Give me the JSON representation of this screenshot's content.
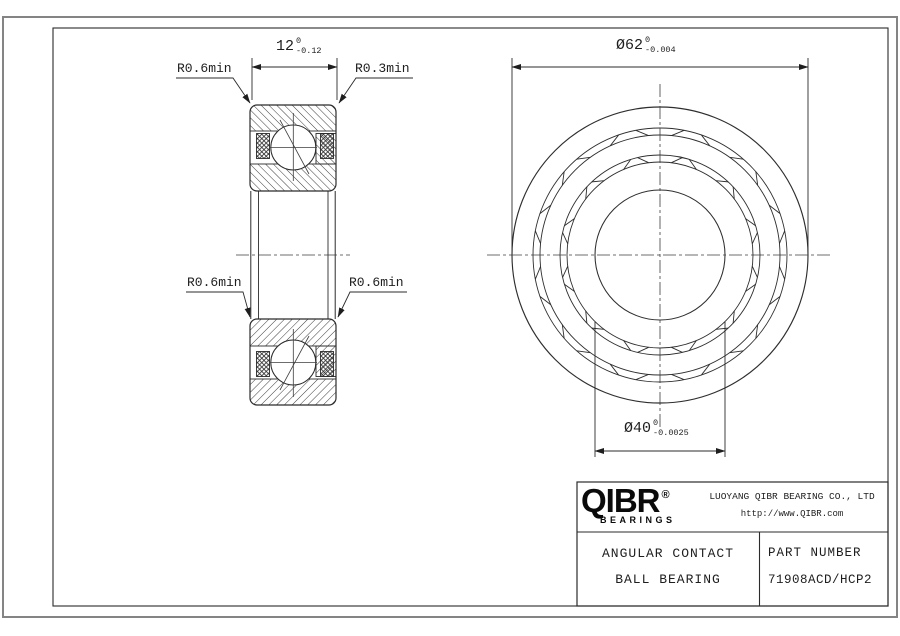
{
  "drawing": {
    "dims": {
      "width": {
        "value": "12",
        "tol_top": "0",
        "tol_bottom": "-0.12"
      },
      "outer_diameter": {
        "value": "Ø62",
        "tol_top": "0",
        "tol_bottom": "-0.004"
      },
      "bore_diameter": {
        "value": "Ø40",
        "tol_top": "0",
        "tol_bottom": "-0.0025"
      }
    },
    "labels": {
      "top_left": "R0.6min",
      "top_right": "R0.3min",
      "mid_left": "R0.6min",
      "mid_right": "R0.6min"
    }
  },
  "title_block": {
    "brand": "QIBR",
    "brand_reg": "®",
    "brand_sub": "BEARINGS",
    "company": "LUOYANG QIBR BEARING CO., LTD",
    "website": "http://www.QIBR.com",
    "product_line1": "ANGULAR CONTACT",
    "product_line2": "BALL BEARING",
    "part_number_label": "PART NUMBER",
    "part_number": "71908ACD/HCP2"
  }
}
